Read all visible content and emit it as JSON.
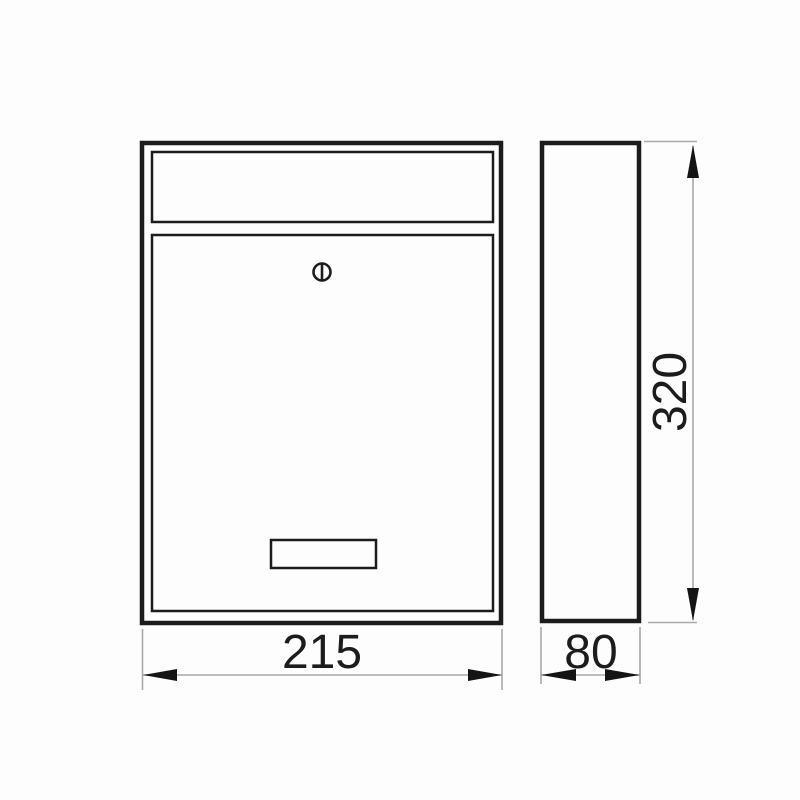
{
  "drawing": {
    "type": "technical-dimension-diagram",
    "subject": "wall-mounted mailbox, front and side orthographic views",
    "dimensions": {
      "width": "215",
      "depth": "80",
      "height": "320"
    },
    "symbols": {
      "lock": "circle-with-vertical-bar"
    },
    "colors": {
      "outline": "#1c1c1c",
      "dimension_line": "#aaaaaa",
      "arrowhead": "#141414",
      "text": "#1c1c1c",
      "background": "#fdfdfd"
    }
  }
}
